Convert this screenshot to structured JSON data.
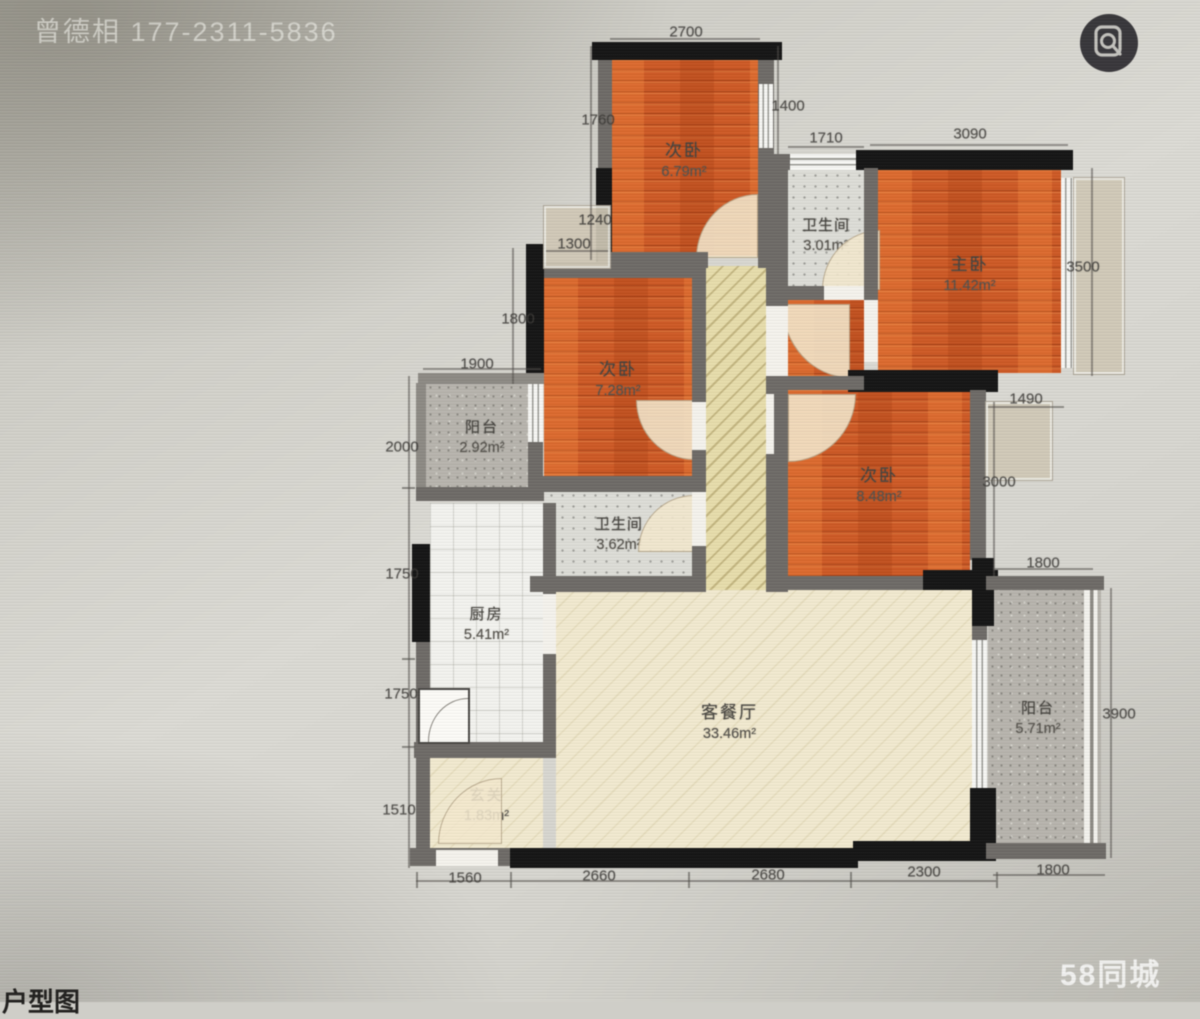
{
  "watermark_top": "曾德相 177-2311-5836",
  "brand_watermark": "58同城",
  "corner_label": "户型图",
  "rooms": [
    {
      "name": "次卧",
      "area": "6.79m²"
    },
    {
      "name": "卫生间",
      "area": "3.01m²"
    },
    {
      "name": "主卧",
      "area": "11.42m²"
    },
    {
      "name": "次卧",
      "area": "7.28m²"
    },
    {
      "name": "卫生间",
      "area": "3.62m²"
    },
    {
      "name": "阳台",
      "area": "2.92m²"
    },
    {
      "name": "厨房",
      "area": "5.41m²"
    },
    {
      "name": "客餐厅",
      "area": "33.46m²"
    },
    {
      "name": "次卧",
      "area": "8.48m²"
    },
    {
      "name": "阳台",
      "area": "5.71m²"
    },
    {
      "name": "玄关",
      "area": "1.83m²"
    }
  ],
  "dims": {
    "top": [
      "2700",
      "1400",
      "1710",
      "3090"
    ],
    "left": [
      "1760",
      "1240",
      "1300",
      "1800",
      "1900",
      "2000",
      "1750",
      "1750",
      "1510"
    ],
    "right": [
      "3500",
      "1490",
      "3000",
      "1800",
      "3900"
    ],
    "bottom": [
      "1560",
      "2660",
      "2680",
      "2300",
      "1800"
    ]
  },
  "colors": {
    "wood_floor": "#cd5a26",
    "living_floor": "#f1e9cf",
    "hall_floor": "#e6dcab",
    "bath_floor": "#dcdcd6",
    "balcony_floor": "#b7b4ad",
    "wall_black": "#161616",
    "wall_gray": "#6e6b67"
  }
}
